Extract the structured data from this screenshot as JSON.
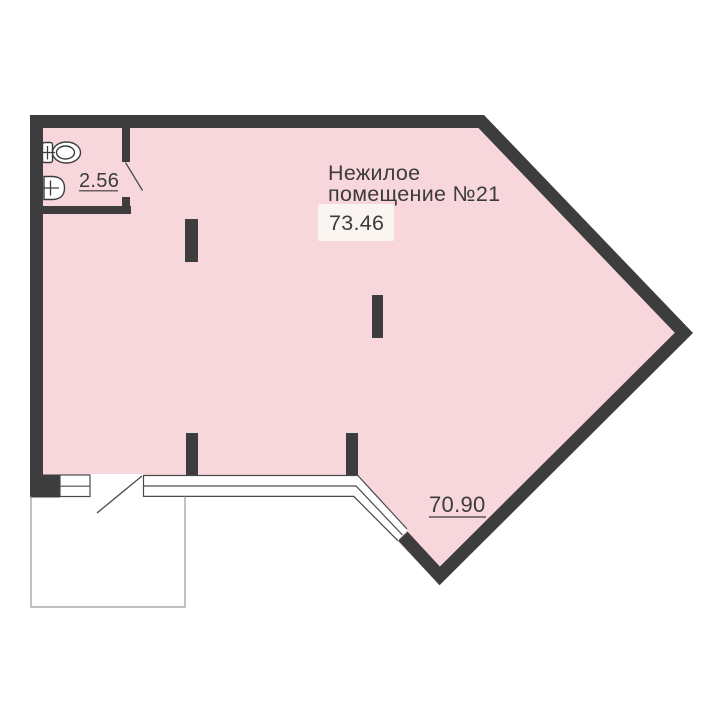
{
  "plan": {
    "room": {
      "name_line1": "Нежилое",
      "name_line2": "помещение №21",
      "area": "73.46",
      "total_area": "70.90"
    },
    "bathroom": {
      "area": "2.56"
    },
    "fixtures": {
      "toilet": "toilet-icon",
      "sink": "sink-icon"
    },
    "colors": {
      "room_fill": "#f7d7db",
      "wall": "#3d3d3d",
      "area_badge_fill": "#fbf5f1",
      "text": "#3b3b3b",
      "thin_line": "#4a4a4a",
      "terrace_line": "#9a9a9a",
      "background": "#ffffff"
    }
  }
}
